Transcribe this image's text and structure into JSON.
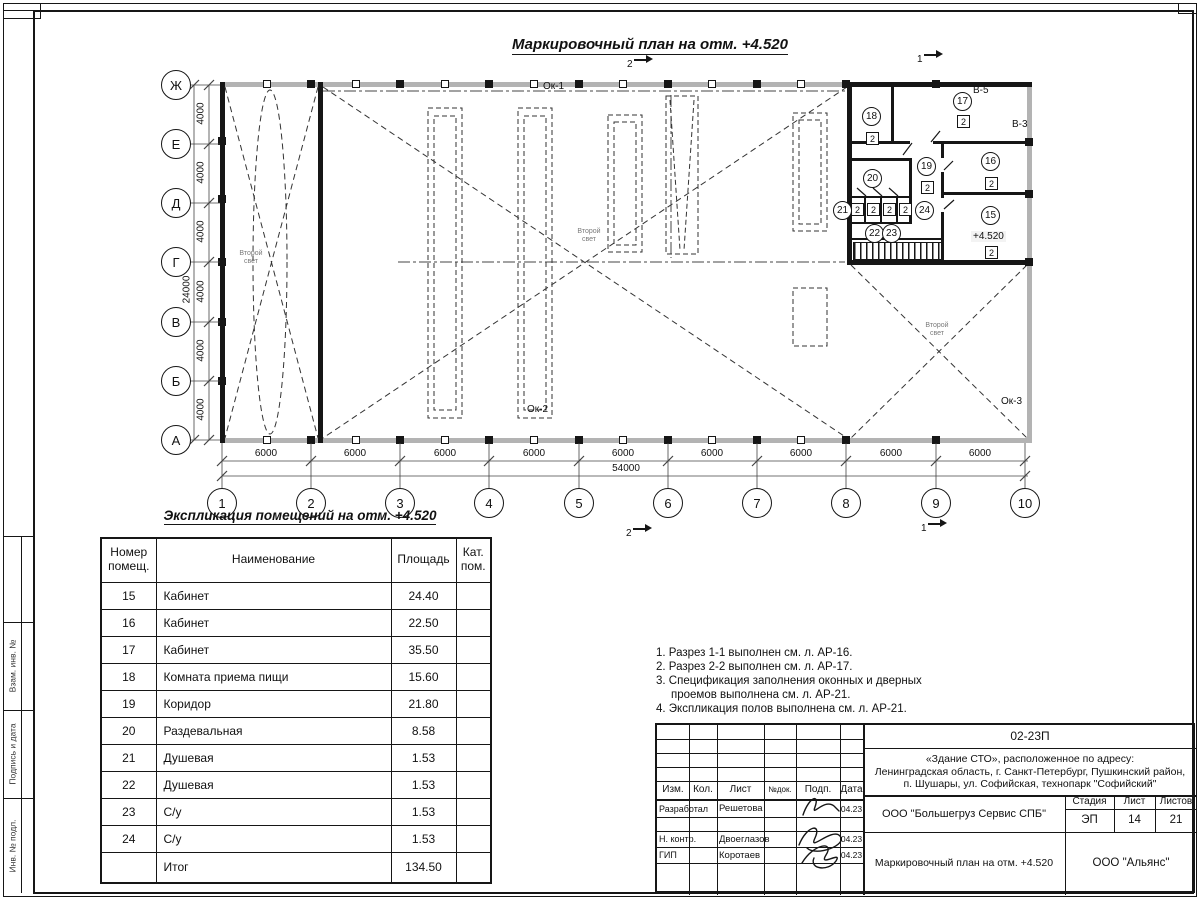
{
  "sheet_title": "Маркировочный план на отм. +4.520",
  "plan": {
    "grid_rows": [
      "Ж",
      "Е",
      "Д",
      "Г",
      "В",
      "Б",
      "А"
    ],
    "grid_cols": [
      "1",
      "2",
      "3",
      "4",
      "5",
      "6",
      "7",
      "8",
      "9",
      "10"
    ],
    "dim_h_span": "6000",
    "dim_h_total": "54000",
    "dim_v_span": "4000",
    "dim_v_total": "24000",
    "window_labels": [
      "Ок-1",
      "Ок-2",
      "Ок-3"
    ],
    "vent_labels": [
      "В-5",
      "В-3"
    ],
    "elevation": "+4.520",
    "second_light": "Второй свет",
    "door_mark": "2",
    "rooms": [
      "15",
      "16",
      "17",
      "18",
      "19",
      "20",
      "21",
      "22",
      "23",
      "24"
    ],
    "section_1": "1",
    "section_2": "2"
  },
  "table": {
    "title": "Экспликация помещений на отм. +4.520",
    "headers": {
      "num": "Номер помещ.",
      "name": "Наименование",
      "area": "Площадь",
      "cat": "Кат. пом."
    },
    "rows": [
      {
        "num": "15",
        "name": "Кабинет",
        "area": "24.40"
      },
      {
        "num": "16",
        "name": "Кабинет",
        "area": "22.50"
      },
      {
        "num": "17",
        "name": "Кабинет",
        "area": "35.50"
      },
      {
        "num": "18",
        "name": "Комната приема пищи",
        "area": "15.60"
      },
      {
        "num": "19",
        "name": "Коридор",
        "area": "21.80"
      },
      {
        "num": "20",
        "name": "Раздевальная",
        "area": "8.58"
      },
      {
        "num": "21",
        "name": "Душевая",
        "area": "1.53"
      },
      {
        "num": "22",
        "name": "Душевая",
        "area": "1.53"
      },
      {
        "num": "23",
        "name": "С/у",
        "area": "1.53"
      },
      {
        "num": "24",
        "name": "С/у",
        "area": "1.53"
      }
    ],
    "total_label": "Итог",
    "total_area": "134.50"
  },
  "notes": [
    "1. Разрез 1-1 выполнен см. л. АР-16.",
    "2. Разрез 2-2 выполнен см. л. АР-17.",
    "3. Спецификация заполнения оконных и дверных проемов выполнена см. л. АР-21.",
    "4. Экспликация полов выполнена см. л. АР-21."
  ],
  "stamp": {
    "code": "02-23П",
    "address_line1": "«Здание СТО», расположенное по адресу:",
    "address_line2": "Ленинградская область, г. Санкт-Петербург, Пушкинский район,",
    "address_line3": "п. Шушары, ул. Софийская, технопарк \"Софийский\"",
    "cols": [
      "Изм.",
      "Кол.",
      "Лист",
      "№док.",
      "Подп.",
      "Дата"
    ],
    "developed_label": "Разработал",
    "developed_name": "Решетова",
    "ncontrol_label": "Н. контр.",
    "ncontrol_name": "Двоеглазов",
    "gip_label": "ГИП",
    "gip_name": "Коротаев",
    "date": "04.23",
    "org1": "ООО \"Большегруз Сервис СПБ\"",
    "stage_label": "Стадия",
    "sheet_label": "Лист",
    "sheets_label": "Листов",
    "stage": "ЭП",
    "sheet_no": "14",
    "sheets_total": "21",
    "doc_title": "Маркировочный план на отм. +4.520",
    "org2": "ООО \"Альянс\""
  },
  "margin_labels": [
    "Взам. инв. №",
    "Подпись и дата",
    "Инв. № подл."
  ]
}
